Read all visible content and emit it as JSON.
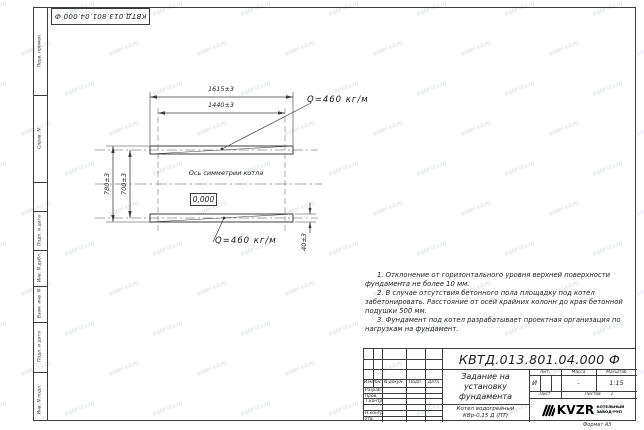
{
  "sheet": {
    "stamp_top_left": "КВТД.013.801.04.000 Ф",
    "format_label": "Формат А3",
    "watermark": "kotel-kv.ru"
  },
  "margin": {
    "perv_primen": "Перв. примен.",
    "sprav": "Справ. N",
    "podp_data_top": "Подп. и дата",
    "inv_dubl": "Инв. N дубл.",
    "vzam_inv": "Взам. инв. N",
    "podp_data_bottom": "Подп. и дата",
    "inv_podl": "Инв. N подл."
  },
  "drawing": {
    "dim_top_outer": "1615±3",
    "dim_top_inner": "1440±3",
    "dim_left_outer": "780±3",
    "dim_left_inner": "700±3",
    "dim_rail": "40±3",
    "load_top": "Q=460 кг/м",
    "load_bottom": "Q=460 кг/м",
    "axis_label": "Ось симметрии котла",
    "level": "0,000"
  },
  "notes": {
    "n1": "1. Отклонение от горизонтального уровня верхней поверхности фундамента не более 10 мм.",
    "n2": "2. В случае отсутствия бетонного пола площадку под котел забетонировать. Расстояние от осей крайних колонн до края бетонной подушки 500 мм.",
    "n3": "3. Фундамент под котел разрабатывает проектная организация по нагрузкам на фундамент."
  },
  "titleblock": {
    "doc_number": "КВТД.013.801.04.000 Ф",
    "title": "Задание на установку фундамента",
    "product": "Котел водогрейный КВр-0,15 Д (ПТ)",
    "col_izm": "Изм.",
    "col_list": "Лист",
    "col_doc": "N докум.",
    "col_podp": "Подп.",
    "col_data": "Дата",
    "row_razrab": "Разраб.",
    "row_prov": "Пров.",
    "row_tkontr": "Т.контр.",
    "row_nkontr": "Н.контр.",
    "row_utv": "Утв.",
    "lit_label": "Лит.",
    "mass_label": "Масса",
    "scale_label": "Масштаб",
    "lit_value": "И",
    "mass_value": "-",
    "scale_value": "1:15",
    "sheet_label": "Лист",
    "sheets_label": "Листов",
    "sheets_value": "1",
    "logo_text": "KVZR",
    "logo_caption_1": "КОТЕЛЬНЫЙ",
    "logo_caption_2": "ЗАВОД-РЭП"
  }
}
